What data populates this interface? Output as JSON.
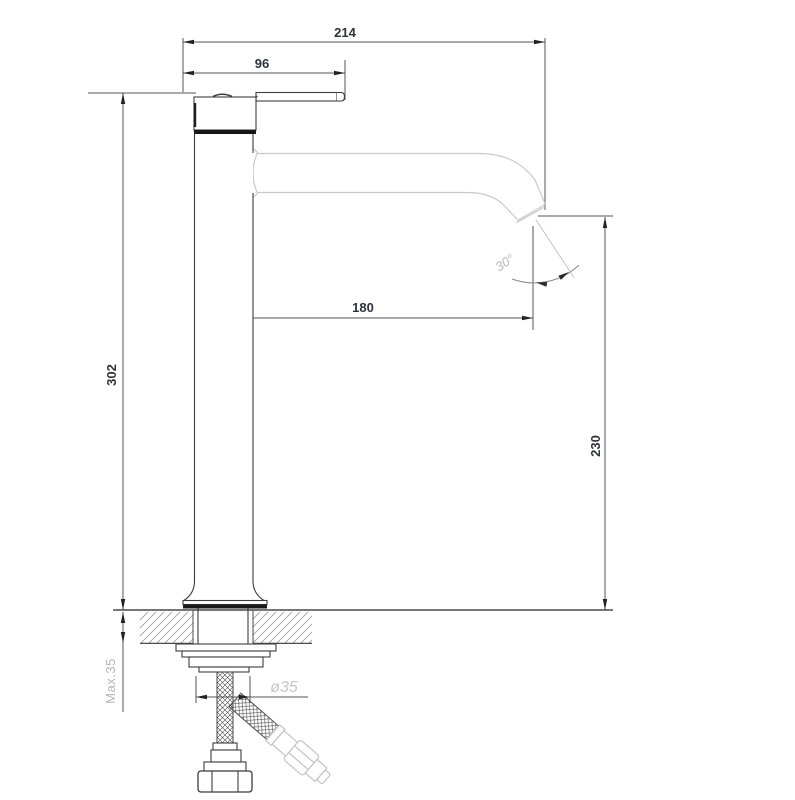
{
  "drawing": {
    "dimensions": {
      "overall_width": "214",
      "handle_reach": "96",
      "body_height": "302",
      "spout_reach": "180",
      "outlet_height": "230",
      "outlet_angle": "30°",
      "max_mounting_thickness": "Max.35",
      "shank_diameter": "ø35"
    },
    "colors": {
      "outline_dark": "#3c3c3c",
      "dimension_line": "#555555",
      "dimension_text": "#2e323b",
      "annotation_light": "#c4c4c4",
      "annotation_text_light": "#b9b9b9",
      "hatch_line": "#9a9a9a"
    }
  }
}
